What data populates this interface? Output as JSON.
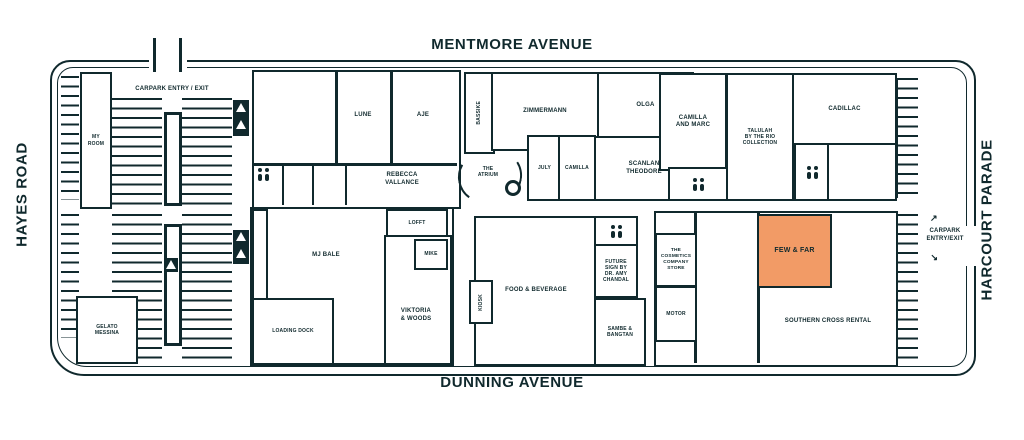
{
  "streets": {
    "top": "MENTMORE AVENUE",
    "bottom": "DUNNING AVENUE",
    "left": "HAYES ROAD",
    "right": "HARCOURT PARADE"
  },
  "carpark": {
    "entry_top": "CARPARK ENTRY / EXIT",
    "entry_right": "CARPARK\nENTRY/EXIT",
    "arrow": "↗"
  },
  "labels": {
    "myroom": "MY\nROOM",
    "lune": "LUNE",
    "aje": "AJE",
    "rebecca": "REBECCA\nVALLANCE",
    "bassike": "BASSIKE",
    "zimmermann": "ZIMMERMANN",
    "olga": "OLGA",
    "july": "JULY",
    "camilla": "CAMILLA",
    "scanlan": "SCANLAN\nTHEODORE",
    "atrium": "THE\nATRIUM",
    "camilla_and_marc": "CAMILLA\nAND MARC",
    "talulah": "TALULAH\nBY THE RIO\nCOLLECTION",
    "cadillac": "CADILLAC",
    "lofft": "LOFFT",
    "mike": "MIKE",
    "mjbale": "MJ BALE",
    "viktoria": "VIKTORIA\n& WOODS",
    "loading": "LOADING DOCK",
    "messina": "GELATO\nMESSINA",
    "kiosk": "KIOSK",
    "foodbev": "FOOD & BEVERAGE",
    "future": "FUTURE\nSIGN BY\nDR. AMY\nCHANDAL",
    "sambe": "SAMBE &\nBANGTAN",
    "tccs": "THE\nCOSMETICS\nCOMPANY\nSTORE",
    "motor": "MOTOR",
    "fewfar": "FEW & FAR",
    "southern": "SOUTHERN CROSS RENTAL"
  },
  "colors": {
    "ink": "#10292d",
    "hl": "#f29b66"
  }
}
